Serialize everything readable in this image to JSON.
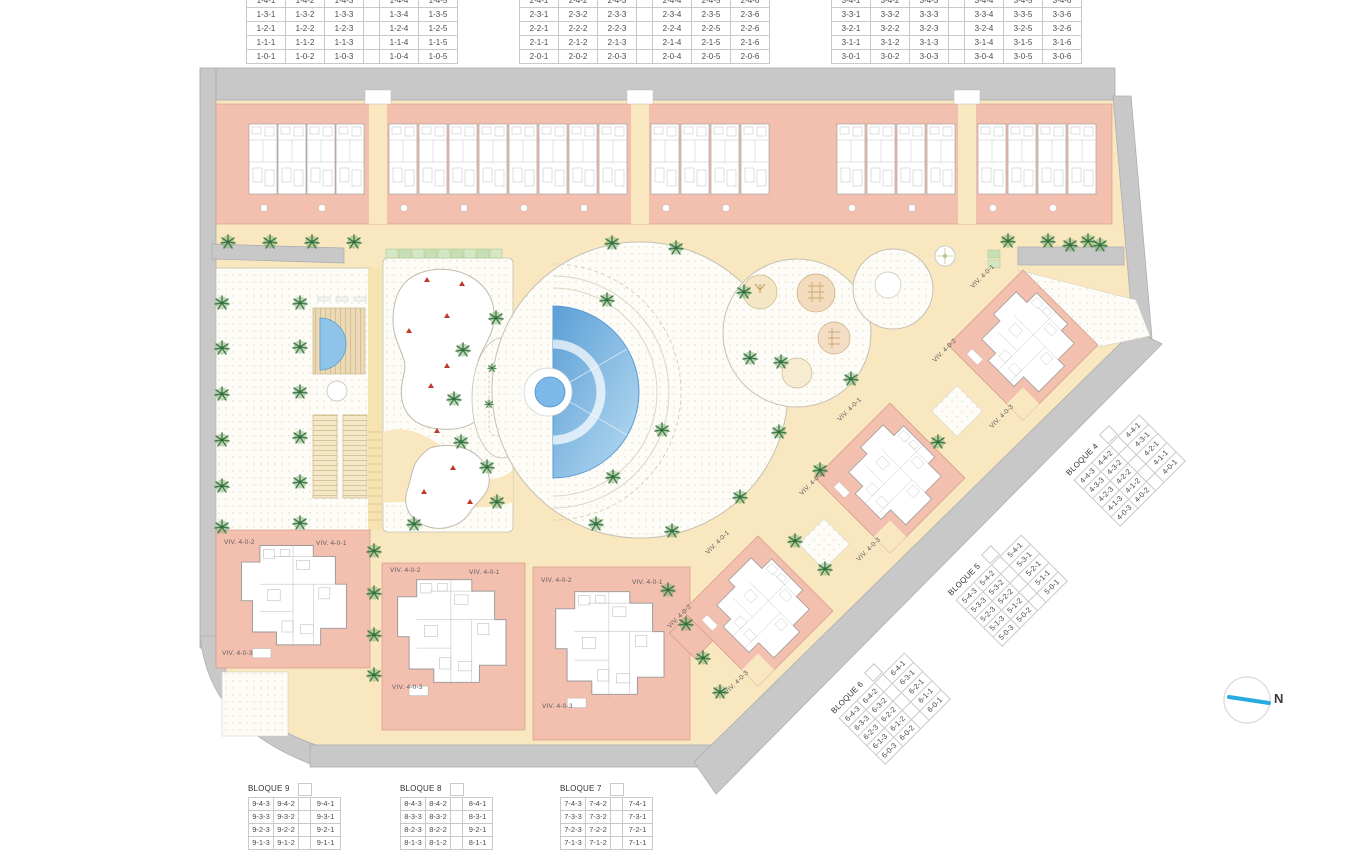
{
  "plan": {
    "compass": {
      "label": "N"
    },
    "viv_labels": {
      "v1": "VIV. 4-0-1",
      "v2": "VIV. 4-0-2",
      "v3": "VIV. 4-0-3"
    }
  },
  "tables": {
    "bloque1": {
      "gap": 3,
      "rows": [
        [
          "1-4-1",
          "1-4-2",
          "1-4-3",
          "1-4-4",
          "1-4-5"
        ],
        [
          "1-3-1",
          "1-3-2",
          "1-3-3",
          "1-3-4",
          "1-3-5"
        ],
        [
          "1-2-1",
          "1-2-2",
          "1-2-3",
          "1-2-4",
          "1-2-5"
        ],
        [
          "1-1-1",
          "1-1-2",
          "1-1-3",
          "1-1-4",
          "1-1-5"
        ],
        [
          "1-0-1",
          "1-0-2",
          "1-0-3",
          "1-0-4",
          "1-0-5"
        ]
      ]
    },
    "bloque2": {
      "gap": 3,
      "rows": [
        [
          "2-4-1",
          "2-4-2",
          "2-4-3",
          "2-4-4",
          "2-4-5",
          "2-4-6"
        ],
        [
          "2-3-1",
          "2-3-2",
          "2-3-3",
          "2-3-4",
          "2-3-5",
          "2-3-6"
        ],
        [
          "2-2-1",
          "2-2-2",
          "2-2-3",
          "2-2-4",
          "2-2-5",
          "2-2-6"
        ],
        [
          "2-1-1",
          "2-1-2",
          "2-1-3",
          "2-1-4",
          "2-1-5",
          "2-1-6"
        ],
        [
          "2-0-1",
          "2-0-2",
          "2-0-3",
          "2-0-4",
          "2-0-5",
          "2-0-6"
        ]
      ]
    },
    "bloque3": {
      "gap": 3,
      "rows": [
        [
          "3-4-1",
          "3-4-2",
          "3-4-3",
          "3-4-4",
          "3-4-5",
          "3-4-6"
        ],
        [
          "3-3-1",
          "3-3-2",
          "3-3-3",
          "3-3-4",
          "3-3-5",
          "3-3-6"
        ],
        [
          "3-2-1",
          "3-2-2",
          "3-2-3",
          "3-2-4",
          "3-2-5",
          "3-2-6"
        ],
        [
          "3-1-1",
          "3-1-2",
          "3-1-3",
          "3-1-4",
          "3-1-5",
          "3-1-6"
        ],
        [
          "3-0-1",
          "3-0-2",
          "3-0-3",
          "3-0-4",
          "3-0-5",
          "3-0-6"
        ]
      ]
    },
    "bloque4": {
      "title": "BLOQUE 4",
      "gap": 2,
      "rows": [
        [
          "4-4-3",
          "4-4-2",
          "4-4-1"
        ],
        [
          "4-3-3",
          "4-3-2",
          "4-3-1"
        ],
        [
          "4-2-3",
          "4-2-2",
          "4-2-1"
        ],
        [
          "4-1-3",
          "4-1-2",
          "4-1-1"
        ],
        [
          "4-0-3",
          "4-0-2",
          "4-0-1"
        ]
      ]
    },
    "bloque5": {
      "title": "BLOQUE 5",
      "gap": 2,
      "rows": [
        [
          "5-4-3",
          "5-4-2",
          "5-4-1"
        ],
        [
          "5-3-3",
          "5-3-2",
          "5-3-1"
        ],
        [
          "5-2-3",
          "5-2-2",
          "5-2-1"
        ],
        [
          "5-1-3",
          "5-1-2",
          "5-1-1"
        ],
        [
          "5-0-3",
          "5-0-2",
          "5-0-1"
        ]
      ]
    },
    "bloque6": {
      "title": "BLOQUE 6",
      "gap": 2,
      "rows": [
        [
          "6-4-3",
          "6-4-2",
          "6-4-1"
        ],
        [
          "6-3-3",
          "6-3-2",
          "6-3-1"
        ],
        [
          "6-2-3",
          "6-2-2",
          "6-2-1"
        ],
        [
          "6-1-3",
          "6-1-2",
          "6-1-1"
        ],
        [
          "6-0-3",
          "6-0-2",
          "6-0-1"
        ]
      ]
    },
    "bloque7": {
      "title": "BLOQUE 7",
      "gap": 2,
      "rows": [
        [
          "7-4-3",
          "7-4-2",
          "7-4-1"
        ],
        [
          "7-3-3",
          "7-3-2",
          "7-3-1"
        ],
        [
          "7-2-3",
          "7-2-2",
          "7-2-1"
        ],
        [
          "7-1-3",
          "7-1-2",
          "7-1-1"
        ]
      ]
    },
    "bloque8": {
      "title": "BLOQUE 8",
      "gap": 2,
      "rows": [
        [
          "8-4-3",
          "8-4-2",
          "8-4-1"
        ],
        [
          "8-3-3",
          "8-3-2",
          "8-3-1"
        ],
        [
          "8-2-3",
          "8-2-2",
          "9-2-1"
        ],
        [
          "8-1-3",
          "8-1-2",
          "8-1-1"
        ]
      ]
    },
    "bloque9": {
      "title": "BLOQUE 9",
      "gap": 2,
      "rows": [
        [
          "9-4-3",
          "9-4-2",
          "9-4-1"
        ],
        [
          "9-3-3",
          "9-3-2",
          "9-3-1"
        ],
        [
          "9-2-3",
          "9-2-2",
          "9-2-1"
        ],
        [
          "9-1-3",
          "9-1-2",
          "9-1-1"
        ]
      ]
    }
  },
  "colors": {
    "road": "#c8c8c8",
    "building": "#f3bfae",
    "path": "#f9e7c0",
    "pool": "#5b9bd5",
    "tree": "#3f7d4b",
    "compass_needle": "#29abe2"
  }
}
